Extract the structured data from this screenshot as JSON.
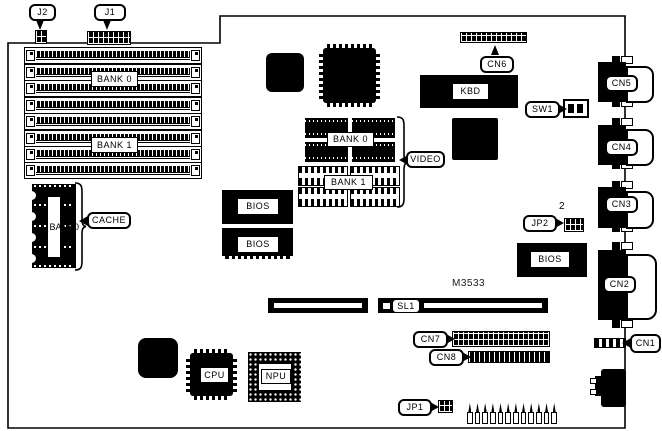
{
  "connector_labels": {
    "j1": "J1",
    "j2": "J2",
    "cn1": "CN1",
    "cn2": "CN2",
    "cn3": "CN3",
    "cn4": "CN4",
    "cn5": "CN5",
    "cn6": "CN6",
    "cn7": "CN7",
    "cn8": "CN8",
    "jp1": "JP1",
    "jp2": "JP2",
    "sw1": "SW1",
    "sl1": "SL1"
  },
  "chip_labels": {
    "kbd": "KBD",
    "cpu": "CPU",
    "npu": "NPU",
    "bios": "BIOS",
    "part_number": "M3533"
  },
  "memory_labels": {
    "simm_bank0": "BANK 0",
    "simm_bank1": "BANK 1",
    "video_bank0": "BANK 0",
    "video_bank1": "BANK 1",
    "video": "VIDEO",
    "cache": "CACHE",
    "cache_bank_vertical": "BANK0"
  },
  "annotations": {
    "jp2_pin2": "2"
  },
  "colors": {
    "ink": "#000000",
    "background": "#ffffff"
  }
}
